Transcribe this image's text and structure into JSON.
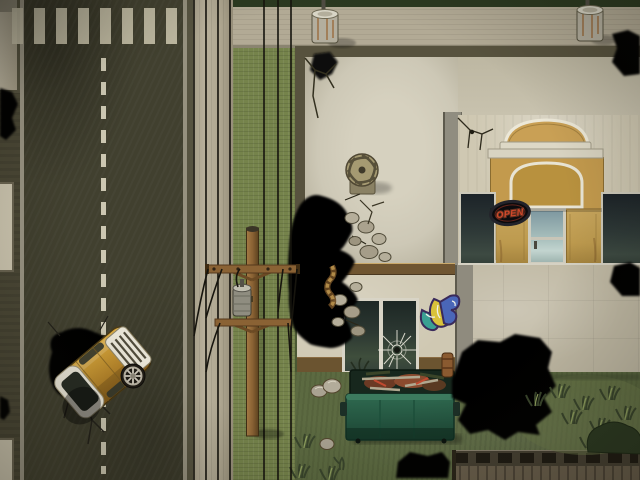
{
  "window": {
    "title": "Top-down survival RPG street scene",
    "resolution": "640x480",
    "perspective": "top-down"
  },
  "signs": {
    "open_sign": {
      "label": "OPEN"
    }
  },
  "scene": {
    "setting": "abandoned street corner with storefront, sinkholes and debris",
    "objects": [
      "asphalt road",
      "crosswalk",
      "dashed lane divider",
      "curb",
      "sidewalk",
      "grass verge",
      "power lines",
      "utility pole",
      "pole transformer",
      "crashed yellow van",
      "road sinkhole",
      "roof sinkhole",
      "yard sinkhole",
      "edge sinkholes",
      "roof turbine vent",
      "rubble stones",
      "hanging rope",
      "storefront facade",
      "arched sign",
      "neon open sign",
      "glass door",
      "shop window left",
      "shop window right",
      "broken window",
      "bullet hole",
      "graffiti tag",
      "green dumpster",
      "trash pile",
      "metal bollard left",
      "metal bollard right",
      "wooden fence",
      "grass tufts",
      "bush",
      "rocks",
      "wall cracks",
      "drain pipe",
      "sprouts"
    ]
  },
  "colors": {
    "road": "#41402f",
    "grass-field": "#5c6a41",
    "grass-verge": "#75834b",
    "sidewalk": "#b2aa95",
    "roof": "#cdc8b6",
    "facade": "#cfc8b2",
    "storefront-tan": "#c39a4d",
    "dumpster-green": "#2f6a50",
    "car-yellow": "#c8912c",
    "sign-red": "#d1492b",
    "window-dark": "#242d2b",
    "fence-plank": "#6b604d",
    "void-black": "#000000"
  }
}
